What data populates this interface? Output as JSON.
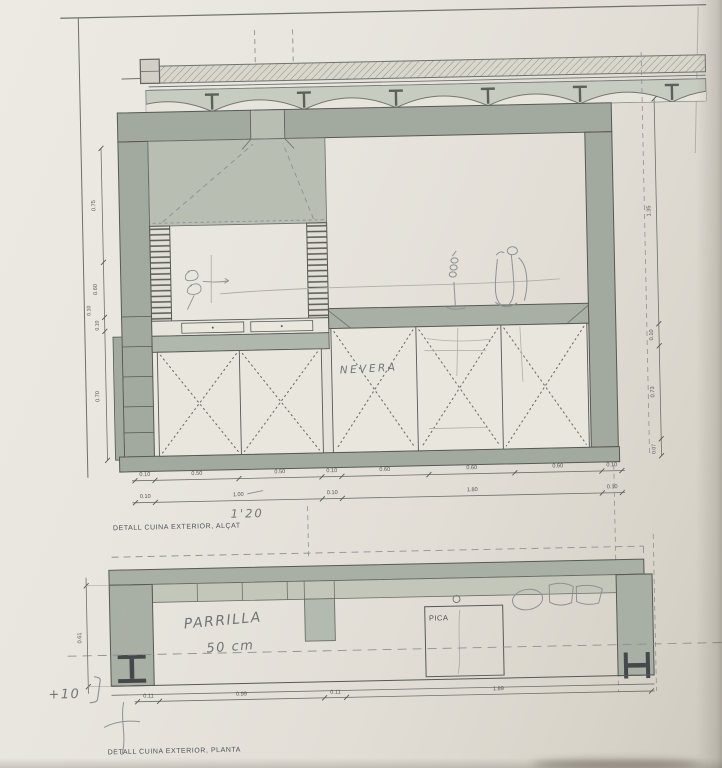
{
  "sheet": {
    "type": "architectural-detail-drawing",
    "elevation": {
      "title": "DETALL CUINA EXTERIOR, ALÇAT",
      "left_dims": [
        "0.75",
        "0.60",
        "0.10",
        "0.10",
        "0.70"
      ],
      "right_dims": [
        "1.35",
        "0.10",
        "0.73",
        "0.07"
      ],
      "dim_row1": [
        "0.10",
        "0.50",
        "0.50",
        "0.10",
        "0.60",
        "0.60",
        "0.60",
        "0.10"
      ],
      "dim_row2": [
        "0.10",
        "1.00",
        "0.10",
        "1.80",
        "0.10"
      ],
      "handwritten_total": "1'20",
      "handwritten_nevera": "NEVERA"
    },
    "plan": {
      "title": "DETALL CUINA EXTERIOR, PLANTA",
      "label_pica": "PICA",
      "handwritten_parrilla_line1": "PARRILLA",
      "handwritten_parrilla_line2": "50 cm",
      "handwritten_level": "+10",
      "depth_dim": "0.61",
      "dim_row": [
        "0.11",
        "0.99",
        "0.11",
        "1.89"
      ]
    },
    "colors": {
      "paper": "#e7e4dc",
      "wall_fill": "#a2aaa0",
      "hood_fill": "#b8beb2",
      "vault_fill": "#c7ccc0",
      "ink_line": "#565954",
      "pencil": "#8e9194",
      "dim_text": "#55585c"
    }
  }
}
